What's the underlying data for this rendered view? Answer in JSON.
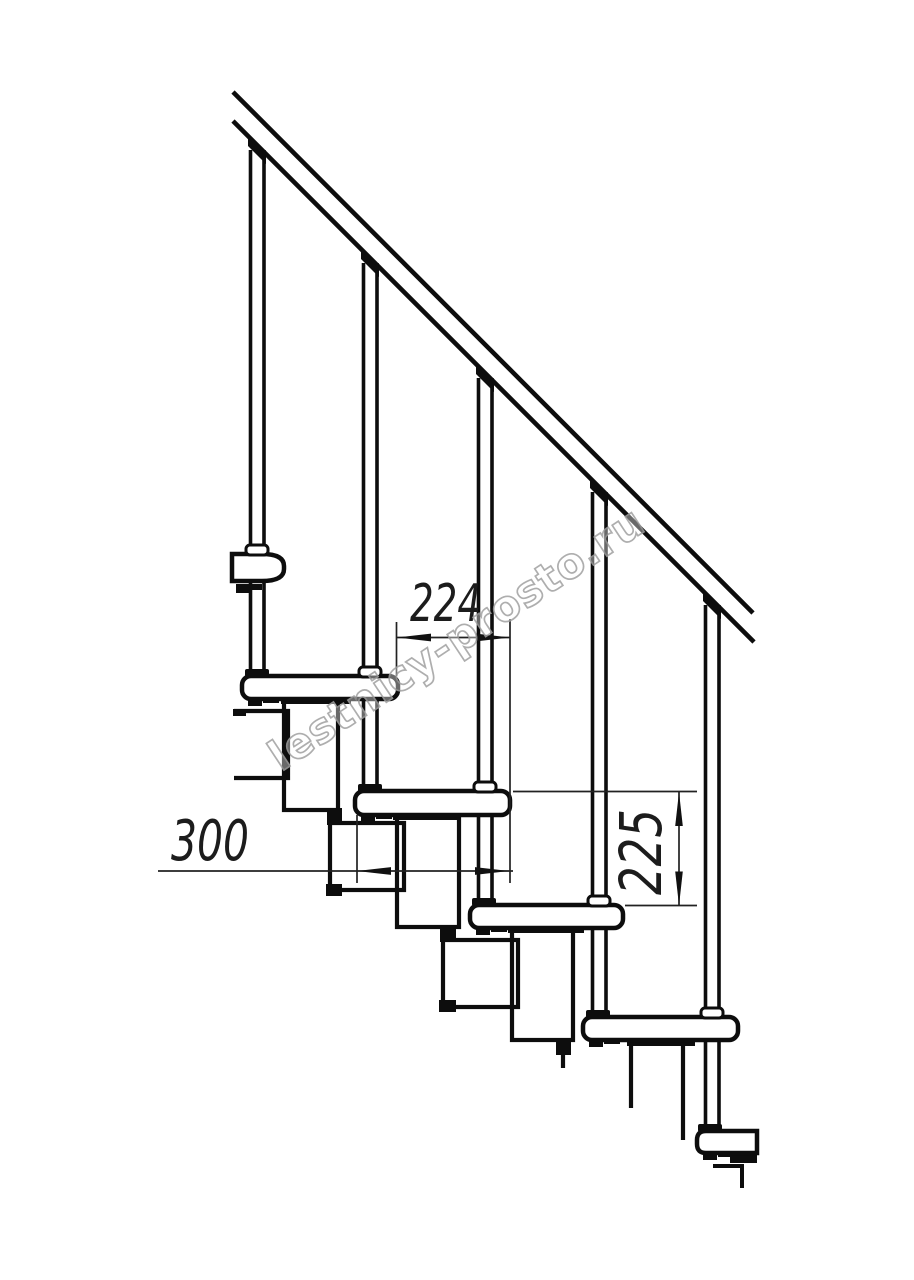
{
  "drawing": {
    "type": "technical side-view drawing of a modular staircase fragment",
    "background": "#ffffff",
    "line_color": "#0d0d0d",
    "dimension_line_color": "#222222",
    "treads_visible": 6,
    "balusters_visible": 5,
    "handrail": "single sloped rail, two parallel lines, ~45 degrees"
  },
  "dimensions": {
    "run": {
      "value": "224",
      "orientation": "horizontal",
      "units_implied": "mm"
    },
    "tread_depth": {
      "value": "300",
      "orientation": "horizontal",
      "units_implied": "mm"
    },
    "rise": {
      "value": "225",
      "orientation": "vertical",
      "units_implied": "mm"
    }
  },
  "watermark": {
    "text": "lestnicy-prosto.ru",
    "color": "#a0a0a0",
    "rotation_deg": -33.5
  }
}
